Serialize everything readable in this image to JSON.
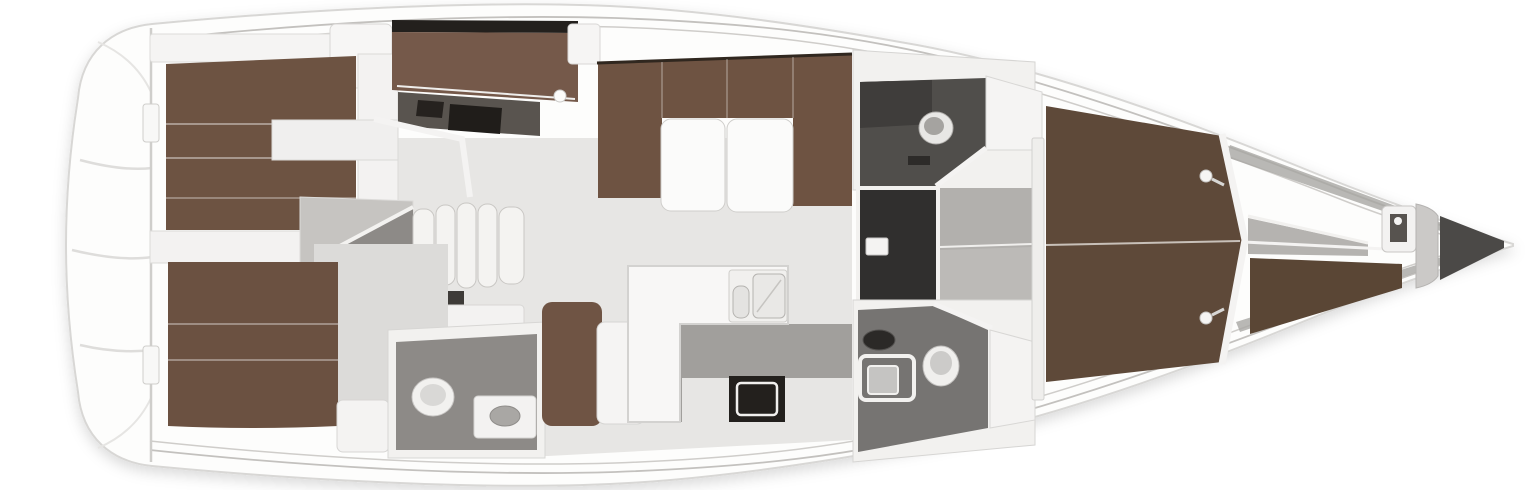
{
  "meta": {
    "title": "Sailing yacht interior floor plan — overhead view",
    "description": "Top-down 3D rendered deck layout of a sailing yacht: stern swim platform at left, two aft double cabins, companionway steps over the engine compartment, aft bathroom, L-shaped galley with double sink and stove, salon with U-shaped settee and split folding table, two forward bathrooms with a separate dark shower room, forward owner's cabin with island double berth and reading lights, and bow anchor locker with windlass. Bow points to the right.",
    "orientation": "Bow right, stern left",
    "cabin_count": "3",
    "head_count": "3"
  },
  "palette": {
    "hull_white": "#fdfdfc",
    "hull_stroke": "#d8d7d5",
    "deck_line": "#c3c1be",
    "floor_light": "#e7e6e4",
    "floor_mid": "#b2b0ad",
    "floor_dark": "#8d8a87",
    "head_floor": "#767472",
    "shower_dark": "#302f2e",
    "berth_brown": "#6d5342",
    "berth_brown_dark": "#5e4939",
    "settee_brown": "#6e5342",
    "accent_black": "#23201d",
    "furniture_white": "#f4f3f2"
  },
  "regions": [
    {
      "id": "hull",
      "label": "Hull outline with side decks and toe-rail lines"
    },
    {
      "id": "swim-platform",
      "label": "Stern transom and swim platform steps"
    },
    {
      "id": "port-aft-cabin",
      "label": "Aft cabin (top) with double berth and entry notch"
    },
    {
      "id": "aft-berth-b",
      "label": "Athwartships aft berth with headboard bar and vanity"
    },
    {
      "id": "companionway",
      "label": "Companionway steps over engine compartment"
    },
    {
      "id": "starboard-aft-cabin",
      "label": "Aft cabin (bottom) with double berth"
    },
    {
      "id": "aft-head",
      "label": "Aft bathroom with toilet and washbasin"
    },
    {
      "id": "galley",
      "label": "L-shaped galley with double sink, stove and bench"
    },
    {
      "id": "salon",
      "label": "Salon with U-shaped settee and split folding table"
    },
    {
      "id": "port-fwd-head",
      "label": "Forward bathroom (top) with toilet and corner seat"
    },
    {
      "id": "shower-room",
      "label": "Separate shower compartment"
    },
    {
      "id": "passageway",
      "label": "Passage to the owner's cabin"
    },
    {
      "id": "starboard-fwd-head",
      "label": "Forward bathroom (bottom) with shower pan, basin and toilet"
    },
    {
      "id": "owners-cabin",
      "label": "Owner's cabin with island double berth and reading lights"
    },
    {
      "id": "bow-stowage",
      "label": "Bow shelves and seat wedges"
    },
    {
      "id": "anchor-locker",
      "label": "Anchor locker with windlass at the bow"
    }
  ]
}
